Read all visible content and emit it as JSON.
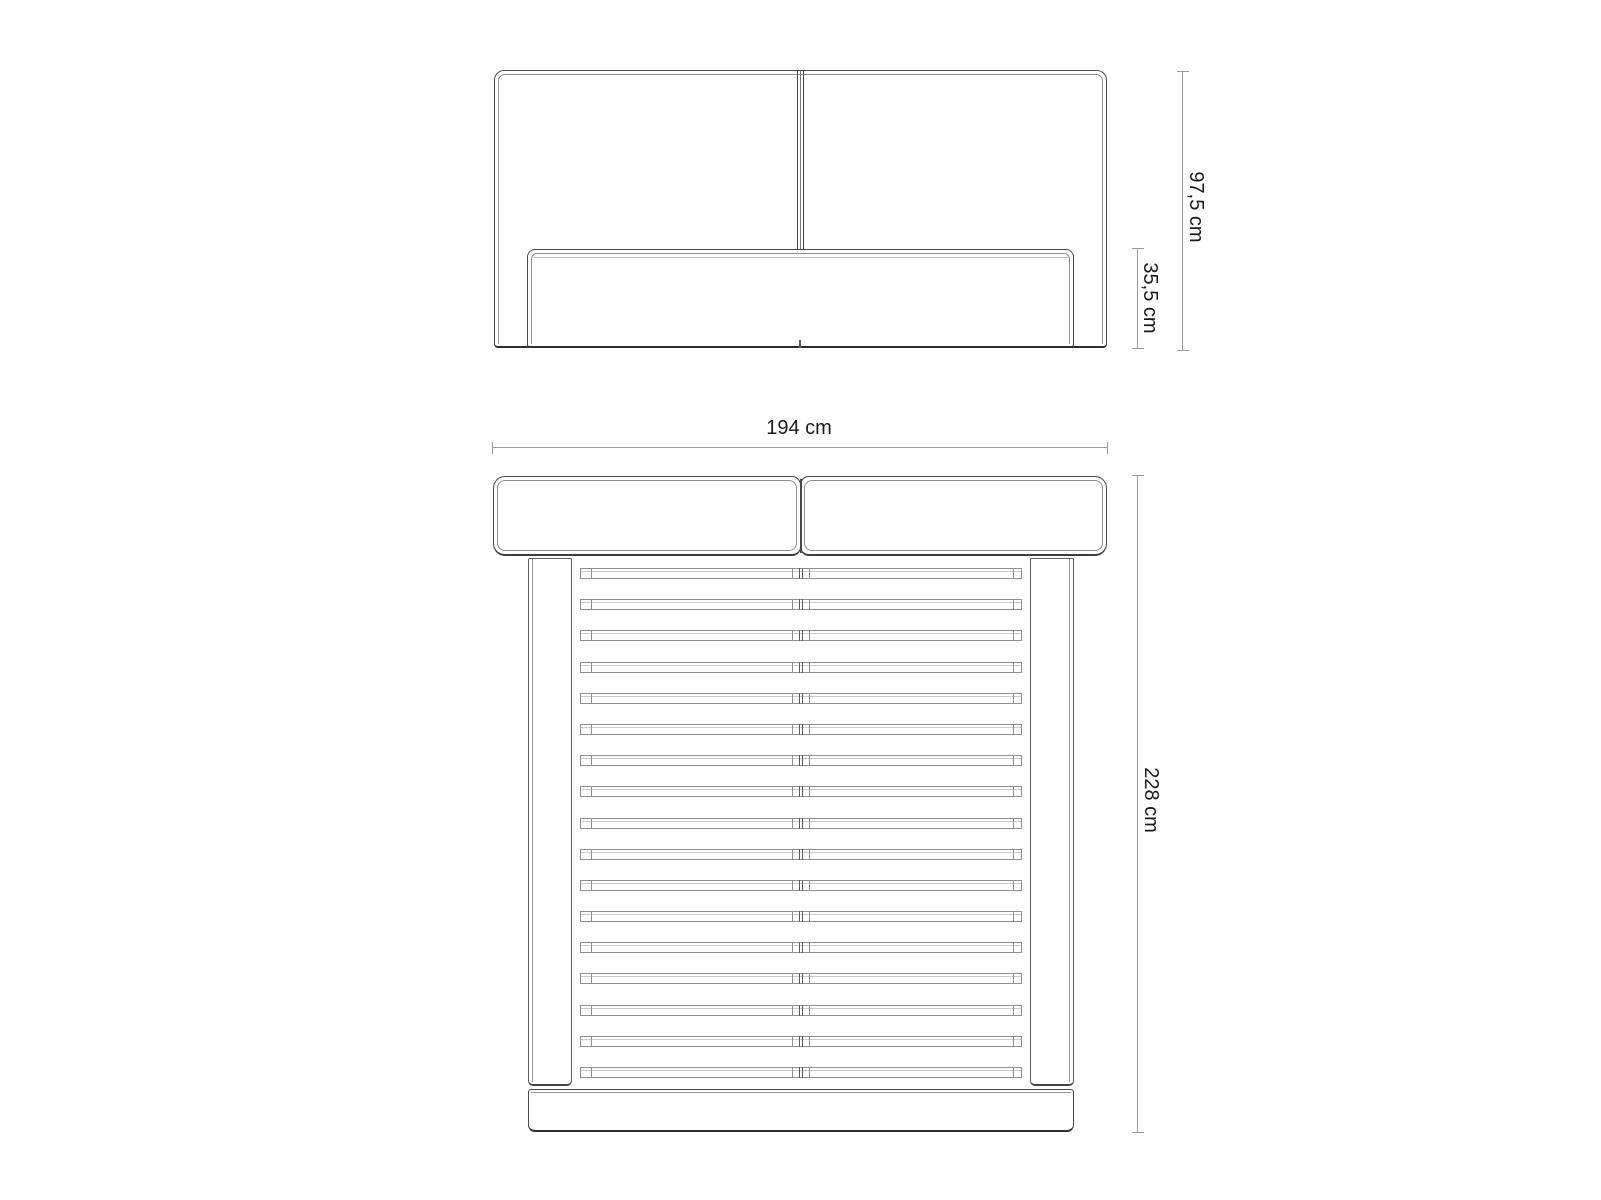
{
  "diagram": {
    "type": "furniture-dimension-drawing",
    "subject": "upholstered bed frame with slatted base",
    "front_view": {
      "total_height_label": "97,5 cm",
      "base_height_label": "35,5 cm"
    },
    "top_view": {
      "width_label": "194 cm",
      "length_label": "228 cm",
      "slat_count": 17
    },
    "colors": {
      "background": "#ffffff",
      "outline": "#4a4a4a",
      "outline_light": "#8f8f8f",
      "dimension_line": "#9c9c9c",
      "text": "#1a1a1a"
    }
  }
}
